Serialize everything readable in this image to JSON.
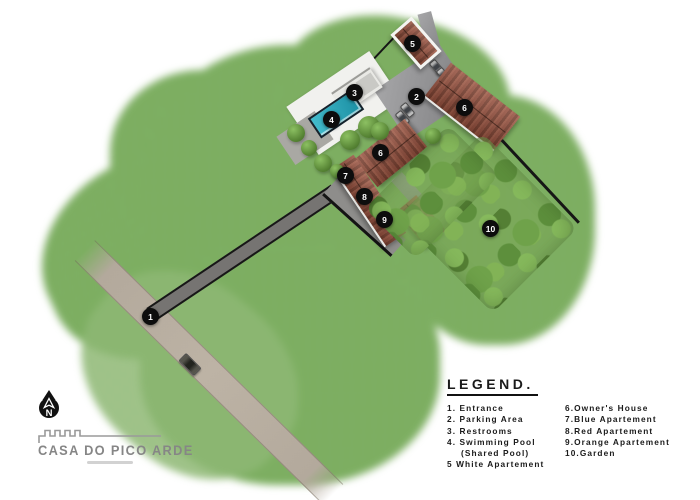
{
  "map": {
    "markers": [
      {
        "number": "1",
        "label": "Entrance"
      },
      {
        "number": "2",
        "label": "Parking Area"
      },
      {
        "number": "3",
        "label": "Restrooms"
      },
      {
        "number": "4",
        "label": "Swimming Pool (Shared Pool)"
      },
      {
        "number": "5",
        "label": "White Apartement"
      },
      {
        "number": "6",
        "label": "Owner's House"
      },
      {
        "number": "6",
        "label": "Owner's House"
      },
      {
        "number": "7",
        "label": "Blue Apartement"
      },
      {
        "number": "8",
        "label": "Red Apartement"
      },
      {
        "number": "9",
        "label": "Orange Apartement"
      },
      {
        "number": "10",
        "label": "Garden"
      }
    ]
  },
  "legend": {
    "title": "LEGEND.",
    "column1": [
      "1. Entrance",
      "2. Parking Area",
      "3. Restrooms",
      "4. Swimming Pool",
      "(Shared Pool)",
      "5 White Apartement"
    ],
    "column2": [
      "6.Owner's House",
      "7.Blue Apartement",
      "8.Red Apartement",
      "9.Orange Apartement",
      "10.Garden"
    ]
  },
  "compass": {
    "letter": "N"
  },
  "branding": {
    "name": "CASA DO PICO ARDE"
  },
  "colors": {
    "grass": "#7cae60",
    "roof_red": "#8f4f3d",
    "pool_water": "#2aa9bd",
    "road_tan": "#b3a99c",
    "paving_gray": "#8e8d8b",
    "marker_black": "#0d0d0d",
    "legend_text": "#1a1a1a",
    "brand_gray": "#868686"
  }
}
